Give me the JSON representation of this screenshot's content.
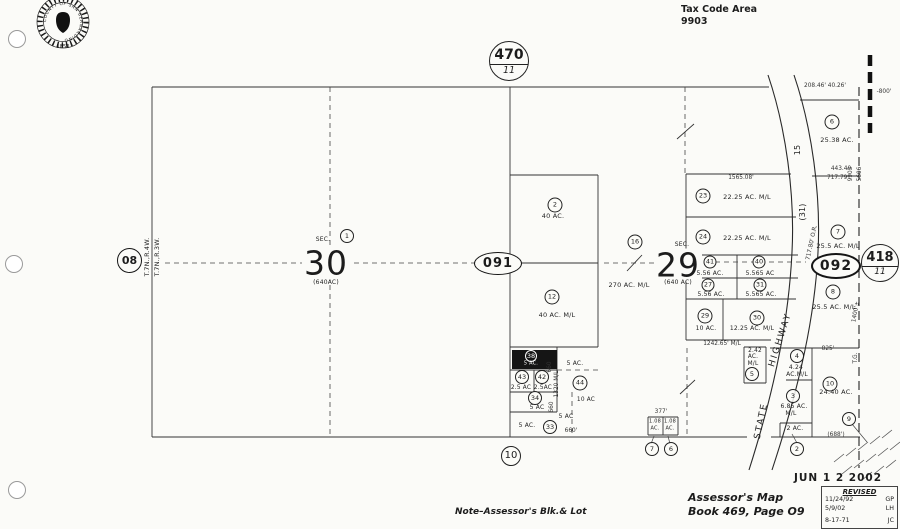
{
  "header": {
    "tax_code_label": "Tax Code Area",
    "tax_code_value": "9903",
    "seal": {
      "ring_text": "COUNTY OF SAN BERNARDINO",
      "year": "1853"
    }
  },
  "footer": {
    "note": "Note–Assessor's Blk.& Lot",
    "map_title_line1": "Assessor's Map",
    "map_title_line2": "Book 469, Page O9",
    "date_stamp": "JUN 1 2 2002",
    "revision": {
      "header": "REVISED",
      "entries": [
        {
          "date": "11/24/92",
          "initials": "GP"
        },
        {
          "date": "5/9/02",
          "initials": "LH"
        },
        {
          "date": "8-17-71",
          "initials": "JC"
        }
      ]
    }
  },
  "map": {
    "page_refs": {
      "left": "08",
      "top": {
        "num": "470",
        "sub": "11"
      },
      "right": {
        "num": "418",
        "sub": "11"
      }
    },
    "flags": {
      "west": "091",
      "east": "092"
    },
    "annotations": [
      {
        "k": "t",
        "t": "T.7N.,R.4W.",
        "x": 147,
        "y": 257,
        "r": -90,
        "fs": 6.5,
        "n": "township-range-west"
      },
      {
        "k": "t",
        "t": "T.7N.,R.3W.",
        "x": 157,
        "y": 257,
        "r": -90,
        "fs": 6.5,
        "n": "township-range-east"
      },
      {
        "k": "c",
        "t": "1",
        "x": 347,
        "y": 236,
        "d": 12,
        "n": "parcel-1-circle"
      },
      {
        "k": "t",
        "t": "SEC.",
        "x": 323,
        "y": 240,
        "fs": 6,
        "n": "sec-label-30"
      },
      {
        "k": "s",
        "t": "30",
        "x": 326,
        "y": 263,
        "n": "section-30-number"
      },
      {
        "k": "t",
        "t": "(640AC)",
        "x": 326,
        "y": 283,
        "fs": 6,
        "n": "section-30-acreage"
      },
      {
        "k": "t",
        "t": "SEC.",
        "x": 682,
        "y": 245,
        "fs": 6,
        "n": "sec-label-29"
      },
      {
        "k": "s",
        "t": "29",
        "x": 678,
        "y": 265,
        "n": "section-29-number"
      },
      {
        "k": "t",
        "t": "(640 AC)",
        "x": 678,
        "y": 283,
        "fs": 6,
        "n": "section-29-acreage"
      },
      {
        "k": "c",
        "t": "2",
        "x": 555,
        "y": 205
      },
      {
        "k": "t",
        "t": "40 AC.",
        "x": 553,
        "y": 216
      },
      {
        "k": "c",
        "t": "12",
        "x": 552,
        "y": 297
      },
      {
        "k": "t",
        "t": "40 AC. M/L",
        "x": 557,
        "y": 315
      },
      {
        "k": "c",
        "t": "16",
        "x": 635,
        "y": 242
      },
      {
        "k": "t",
        "t": "270 AC. M/L",
        "x": 629,
        "y": 285
      },
      {
        "k": "c",
        "t": "23",
        "x": 703,
        "y": 196
      },
      {
        "k": "t",
        "t": "22.25  AC.  M/L",
        "x": 747,
        "y": 197
      },
      {
        "k": "c",
        "t": "24",
        "x": 703,
        "y": 237
      },
      {
        "k": "t",
        "t": "22.25  AC.  M/L",
        "x": 747,
        "y": 238
      },
      {
        "k": "c",
        "t": "41",
        "x": 710,
        "y": 262,
        "d": 11
      },
      {
        "k": "t",
        "t": "5.56 AC.",
        "x": 710,
        "y": 274,
        "fs": 6
      },
      {
        "k": "c",
        "t": "40",
        "x": 759,
        "y": 262,
        "d": 11
      },
      {
        "k": "t",
        "t": "5.565 AC",
        "x": 760,
        "y": 274,
        "fs": 6
      },
      {
        "k": "c",
        "t": "27",
        "x": 708,
        "y": 285,
        "d": 11
      },
      {
        "k": "t",
        "t": "5.56 AC.",
        "x": 711,
        "y": 295,
        "fs": 6
      },
      {
        "k": "c",
        "t": "31",
        "x": 760,
        "y": 285,
        "d": 11
      },
      {
        "k": "t",
        "t": "5.565 AC.",
        "x": 761,
        "y": 295,
        "fs": 6
      },
      {
        "k": "c",
        "t": "29",
        "x": 705,
        "y": 316
      },
      {
        "k": "t",
        "t": "10 AC.",
        "x": 706,
        "y": 329,
        "fs": 6
      },
      {
        "k": "c",
        "t": "30",
        "x": 757,
        "y": 318
      },
      {
        "k": "t",
        "t": "12.25 AC. M/L",
        "x": 752,
        "y": 329,
        "fs": 6
      },
      {
        "k": "d",
        "t": "1565.08'",
        "x": 741,
        "y": 179,
        "n": "dim-1565"
      },
      {
        "k": "d",
        "t": "1242.65' M/L",
        "x": 722,
        "y": 345,
        "n": "dim-1242"
      },
      {
        "k": "c",
        "t": "6",
        "x": 832,
        "y": 122
      },
      {
        "k": "t",
        "t": "25.38 AC.",
        "x": 837,
        "y": 140
      },
      {
        "k": "c",
        "t": "7",
        "x": 838,
        "y": 232
      },
      {
        "k": "t",
        "t": "25.5 AC. M/L",
        "x": 838,
        "y": 246
      },
      {
        "k": "c",
        "t": "8",
        "x": 833,
        "y": 292
      },
      {
        "k": "t",
        "t": "25.5 AC. M/L",
        "x": 834,
        "y": 307
      },
      {
        "k": "c",
        "t": "10",
        "x": 830,
        "y": 384
      },
      {
        "k": "t",
        "t": "24.40 AC.",
        "x": 836,
        "y": 392
      },
      {
        "k": "c",
        "t": "9",
        "x": 849,
        "y": 419,
        "d": 12
      },
      {
        "k": "c",
        "t": "4",
        "x": 797,
        "y": 356,
        "d": 12
      },
      {
        "k": "t",
        "t": "4.24",
        "x": 796,
        "y": 368,
        "fs": 6
      },
      {
        "k": "t",
        "t": "AC.M/L",
        "x": 797,
        "y": 375,
        "fs": 6
      },
      {
        "k": "c",
        "t": "3",
        "x": 793,
        "y": 396,
        "d": 12
      },
      {
        "k": "t",
        "t": "6.85 AC.",
        "x": 794,
        "y": 407,
        "fs": 6
      },
      {
        "k": "t",
        "t": "M/L",
        "x": 791,
        "y": 414,
        "fs": 6
      },
      {
        "k": "t",
        "t": "2.42",
        "x": 755,
        "y": 352,
        "fs": 5.8
      },
      {
        "k": "t",
        "t": "AC.",
        "x": 753,
        "y": 358,
        "fs": 5.8
      },
      {
        "k": "t",
        "t": "M/L",
        "x": 753,
        "y": 365,
        "fs": 5.8
      },
      {
        "k": "c",
        "t": "5",
        "x": 752,
        "y": 374,
        "d": 12
      },
      {
        "k": "t",
        "t": "2 AC.",
        "x": 795,
        "y": 429,
        "fs": 6
      },
      {
        "k": "c",
        "t": "2",
        "x": 797,
        "y": 449,
        "d": 12
      },
      {
        "k": "cw",
        "t": "38",
        "x": 531,
        "y": 356,
        "d": 10,
        "n": "blacked-parcel-number"
      },
      {
        "k": "tw",
        "t": "5 AC.",
        "x": 531,
        "y": 364,
        "fs": 5,
        "n": "blacked-parcel-area"
      },
      {
        "k": "t",
        "t": "5 AC.",
        "x": 575,
        "y": 364,
        "fs": 6
      },
      {
        "k": "c",
        "t": "43",
        "x": 522,
        "y": 377,
        "d": 12
      },
      {
        "k": "c",
        "t": "42",
        "x": 542,
        "y": 377,
        "d": 12
      },
      {
        "k": "t",
        "t": "2.5 AC",
        "x": 521,
        "y": 389,
        "fs": 5.8
      },
      {
        "k": "t",
        "t": "2.5AC",
        "x": 543,
        "y": 389,
        "fs": 5.8
      },
      {
        "k": "c",
        "t": "44",
        "x": 580,
        "y": 383
      },
      {
        "k": "c",
        "t": "34",
        "x": 535,
        "y": 398,
        "d": 12
      },
      {
        "k": "t",
        "t": "5 AC",
        "x": 537,
        "y": 408,
        "fs": 6
      },
      {
        "k": "t",
        "t": "10 AC",
        "x": 586,
        "y": 401,
        "fs": 5.8
      },
      {
        "k": "t",
        "t": "5 AC",
        "x": 566,
        "y": 417,
        "fs": 6
      },
      {
        "k": "t",
        "t": "5 AC.",
        "x": 527,
        "y": 426,
        "fs": 6
      },
      {
        "k": "c",
        "t": "33",
        "x": 550,
        "y": 427,
        "d": 12
      },
      {
        "k": "d",
        "t": "660'",
        "x": 571,
        "y": 432
      },
      {
        "k": "d",
        "t": "660",
        "x": 551,
        "y": 367,
        "r": -90
      },
      {
        "k": "d",
        "t": "1320 M/L",
        "x": 558,
        "y": 384,
        "r": -90
      },
      {
        "k": "d",
        "t": "660",
        "x": 553,
        "y": 407,
        "r": -90
      },
      {
        "k": "d",
        "t": "377'",
        "x": 661,
        "y": 413
      },
      {
        "k": "t",
        "t": "1.08",
        "x": 655,
        "y": 422,
        "fs": 5
      },
      {
        "k": "t",
        "t": "AC.",
        "x": 655,
        "y": 429,
        "fs": 5
      },
      {
        "k": "t",
        "t": "1.08",
        "x": 670,
        "y": 422,
        "fs": 5
      },
      {
        "k": "t",
        "t": "AC.",
        "x": 670,
        "y": 429,
        "fs": 5
      },
      {
        "k": "c",
        "t": "7",
        "x": 652,
        "y": 449,
        "d": 12
      },
      {
        "k": "c",
        "t": "6",
        "x": 671,
        "y": 449,
        "d": 12
      },
      {
        "k": "c",
        "t": "10",
        "x": 511,
        "y": 456,
        "d": 18,
        "fs": 10,
        "n": "block-10-circle"
      },
      {
        "k": "d",
        "t": "208.46'  40.26'",
        "x": 825,
        "y": 87
      },
      {
        "k": "d",
        "t": "-800'",
        "x": 884,
        "y": 93
      },
      {
        "k": "d",
        "t": "443.40",
        "x": 841,
        "y": 170
      },
      {
        "k": "d",
        "t": "717.79'",
        "x": 838,
        "y": 179
      },
      {
        "k": "d",
        "t": "717.80' O.R.",
        "x": 813,
        "y": 243,
        "r": -78
      },
      {
        "k": "d",
        "t": "9903",
        "x": 852,
        "y": 174,
        "r": -90,
        "n": "tax-area-west"
      },
      {
        "k": "d",
        "t": "5606",
        "x": 861,
        "y": 174,
        "r": -90,
        "n": "tax-area-east"
      },
      {
        "k": "d",
        "t": "1400'±",
        "x": 857,
        "y": 312,
        "r": -80
      },
      {
        "k": "d",
        "t": "T.G.",
        "x": 857,
        "y": 358,
        "r": -90
      },
      {
        "k": "d",
        "t": "825'",
        "x": 828,
        "y": 350
      },
      {
        "k": "d",
        "t": "(688')",
        "x": 836,
        "y": 436
      },
      {
        "k": "t",
        "t": "15",
        "x": 798,
        "y": 150,
        "r": -90,
        "fs": 8,
        "n": "highway-route-15"
      },
      {
        "k": "t",
        "t": "(31)",
        "x": 803,
        "y": 212,
        "r": -90,
        "fs": 8,
        "n": "highway-route-31"
      },
      {
        "k": "t",
        "t": "STATE",
        "x": 762,
        "y": 421,
        "r": -78,
        "fs": 9,
        "ls": 2,
        "n": "state-highway-label"
      },
      {
        "k": "t",
        "t": "HIGHWAY",
        "x": 781,
        "y": 340,
        "r": -72,
        "fs": 9,
        "ls": 2,
        "n": "state-highway-label"
      }
    ]
  }
}
